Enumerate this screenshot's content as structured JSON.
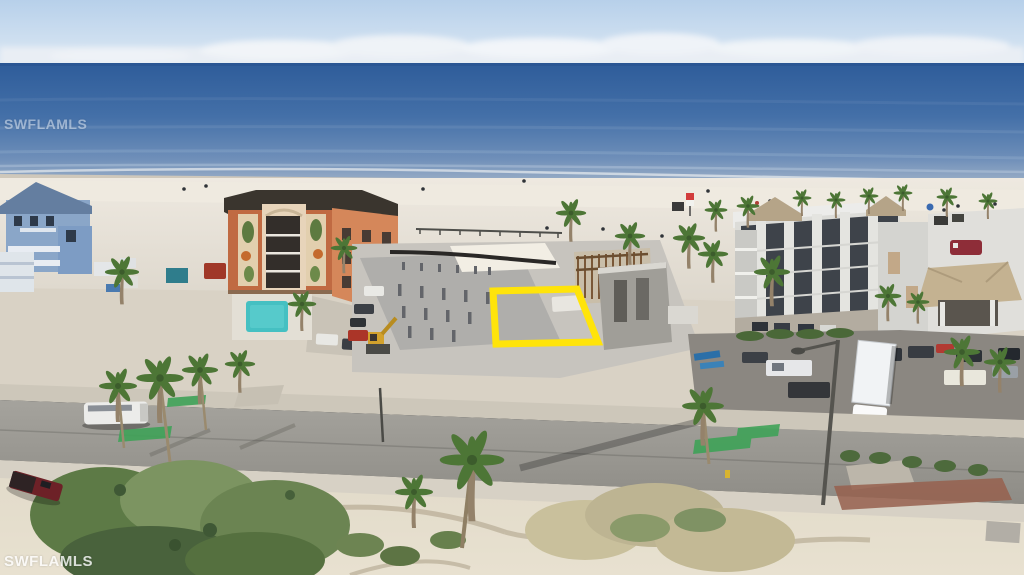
{
  "watermarks": {
    "top": "SWFLAMLS",
    "bottom": "SWFLAMLS"
  },
  "scene": {
    "type": "aerial beachfront real-estate photo",
    "highlighted_parcel_outline_color": "#ffe40a",
    "landmarks": [
      "gulf ocean",
      "white sand beach",
      "vacant lot outlined in yellow",
      "orange condo building with pool",
      "blue beach house",
      "white 4-story condo",
      "hotel with red sign",
      "beachfront road with green bike lanes",
      "palm trees",
      "construction site with pilings",
      "white semi trailer",
      "maroon pickup truck"
    ]
  },
  "palette": {
    "sky": "#bcd4ed",
    "ocean": "#3a68a4",
    "sand": "#e8e2d7",
    "road": "#9a9893",
    "bike_lane_green": "#3fa258",
    "parcel_yellow": "#ffe40a"
  }
}
